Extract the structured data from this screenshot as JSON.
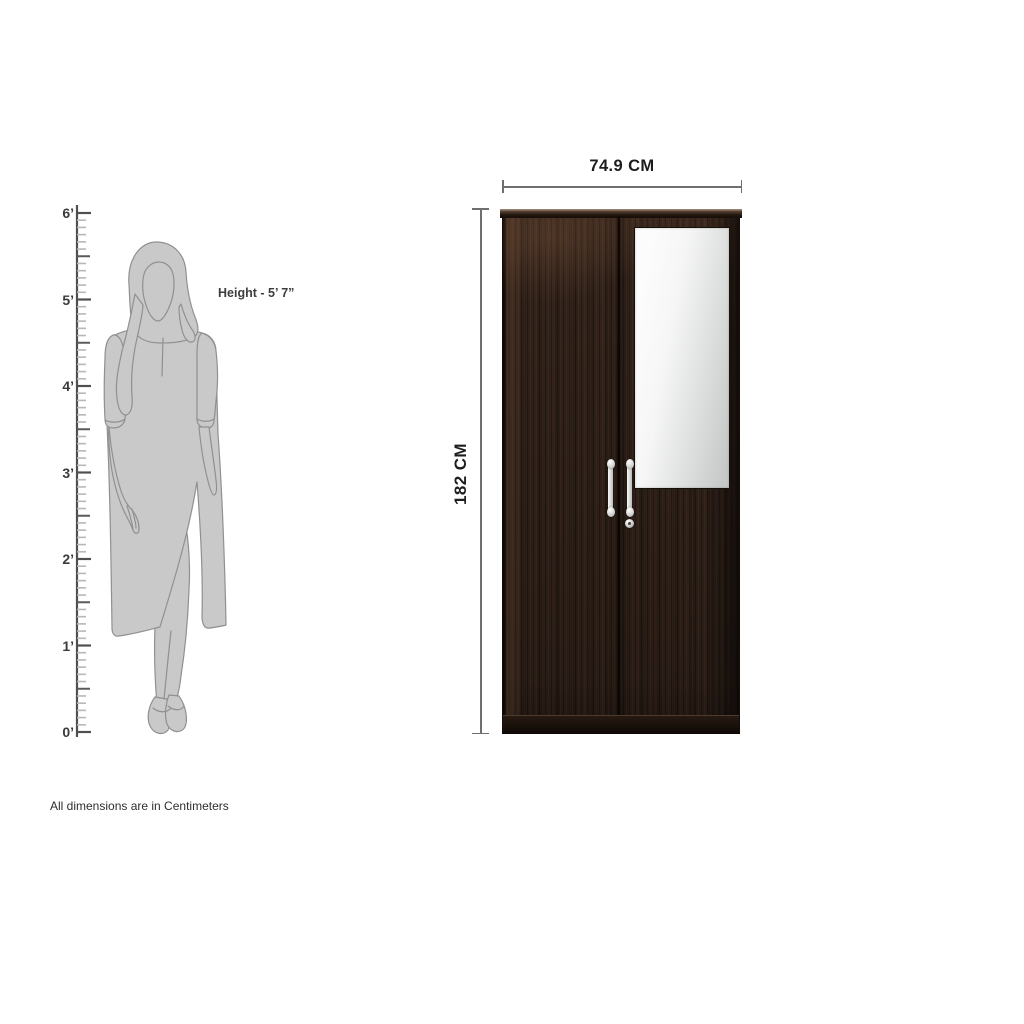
{
  "scale_ruler": {
    "unit": "feet",
    "labels": [
      "6’",
      "5’",
      "4’",
      "3’",
      "2’",
      "1’",
      "0’"
    ],
    "feet_max": 6,
    "feet_min": 0,
    "inches_per_foot": 12
  },
  "person": {
    "height_label": "Height - 5’ 7”"
  },
  "product": {
    "width_label": "74.9 CM",
    "height_label": "182 CM"
  },
  "footnote": "All dimensions are in Centimeters",
  "colors": {
    "wood_dark": "#31221a",
    "wood_edge": "#140d09",
    "mirror_light": "#fcfcfc",
    "mirror_dark": "#c5c8c7",
    "handle_silver": "#e9e9e9",
    "silhouette_fill": "#c9c9c9",
    "silhouette_stroke": "#909090",
    "dimension_line": "#6f6f6f",
    "text_dark": "#1d1d1d",
    "ruler_major": "#4f4f4f",
    "ruler_minor": "#b8b8b8"
  }
}
